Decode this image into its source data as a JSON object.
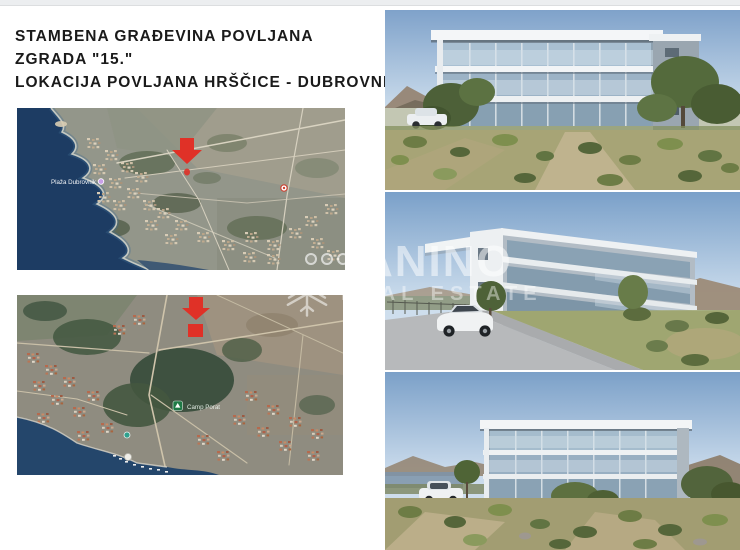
{
  "header": {
    "line1": "STAMBENA GRAĐEVINA POVLJANA",
    "line2": "ZGRADA \"15.\"",
    "line3": "LOKACIJA POVLJANA HRŠČICE - DUBROVNIK"
  },
  "maps": {
    "map1": {
      "description": "satellite overview of Povljana coastline",
      "poi_label": "Plaža Dubrovnik",
      "marker": "red-location-arrow"
    },
    "map2": {
      "description": "satellite close-up of building plot",
      "poi_label": "Camp Porat",
      "marker": "red-location-arrow-and-plot-square"
    }
  },
  "watermark": {
    "brand": "ANINO",
    "tagline": "REAL ESTATE",
    "snowflake_icon": "✳",
    "social_circle_count": "3"
  },
  "colors": {
    "arrow_red": "#e03127",
    "sea_blue": "#1d3c63",
    "sky_blue": "#7fa2ca",
    "title_text": "#1a1a1a",
    "watermark_white": "#ffffff"
  }
}
